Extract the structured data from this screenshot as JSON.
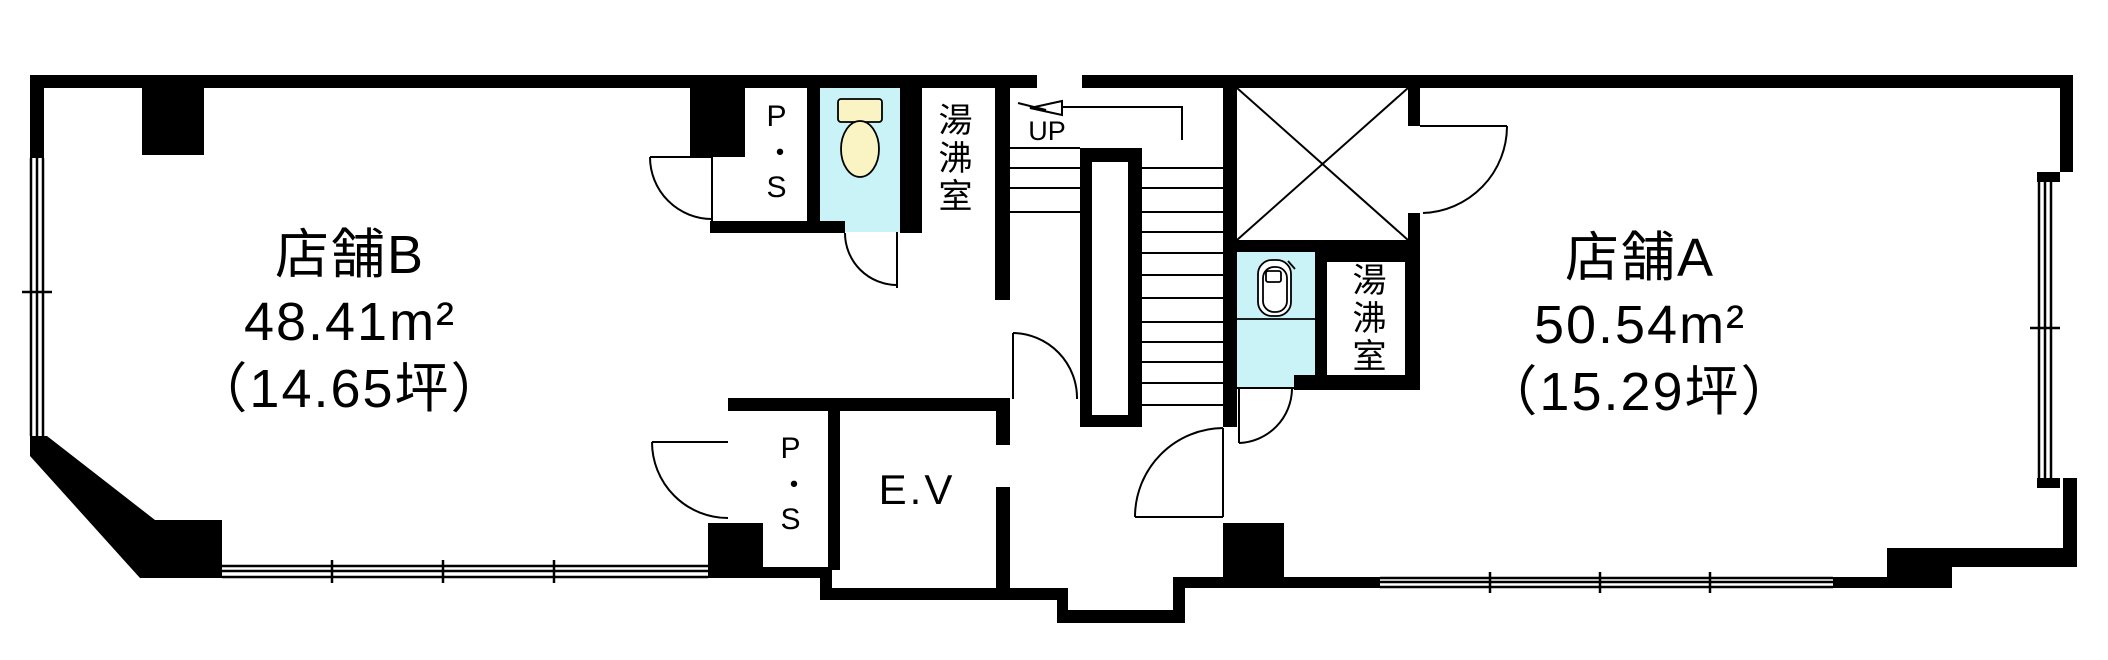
{
  "plan": {
    "title": "tenant-floor-plan",
    "rooms": {
      "shop_b": {
        "name": "店舗B",
        "area_sqm": "48.41m²",
        "area_tsubo": "（14.65坪）"
      },
      "shop_a": {
        "name": "店舗A",
        "area_sqm": "50.54m²",
        "area_tsubo": "（15.29坪）"
      },
      "pipe_space_top": {
        "label": "P・S"
      },
      "pipe_space_bottom": {
        "label": "P・S"
      },
      "elevator": {
        "label": "E.V"
      },
      "kitchenette_left": {
        "label": "湯沸室"
      },
      "kitchenette_right": {
        "label": "湯沸室"
      },
      "stairs": {
        "direction_label": "UP"
      }
    },
    "colors": {
      "wall": "#000000",
      "wet_area": "#c9f3f7",
      "fixture": "#faf4c5",
      "background": "#ffffff",
      "line": "#000000"
    }
  }
}
